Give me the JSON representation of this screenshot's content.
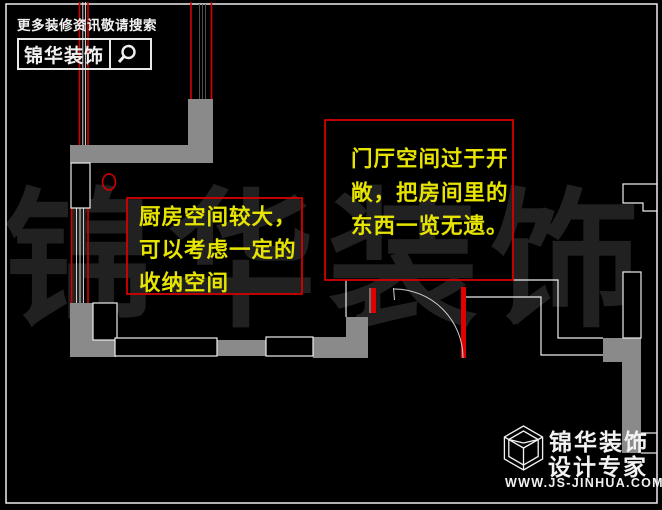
{
  "branding": {
    "tagline": "更多装修资讯敬请搜索",
    "logo_text": "锦华装饰",
    "search_icon": "magnifier-icon"
  },
  "annotations": {
    "kitchen": {
      "lines": [
        "厨房空间较大，",
        "可以考虑一定的",
        "收纳空间"
      ],
      "border_color": "#d40000",
      "text_color": "#e6e400"
    },
    "hallway": {
      "lines": [
        "门厅空间过于开",
        "敞，把房间里的",
        "东西一览无遗。"
      ],
      "border_color": "#d40000",
      "text_color": "#e6e400"
    }
  },
  "watermark": {
    "text": "锦华装饰",
    "color": "#212121"
  },
  "footer_logo": {
    "company": "锦华装饰",
    "slogan": "设计专家",
    "website": "WWW.JS-JINHUA.COM",
    "cube_icon": "cube-logo-icon"
  },
  "plan": {
    "wall_fill_color": "#8a8a8a",
    "line_color": "#ededed",
    "accent_red": "#d40000",
    "door_jamb_red": "#e00000",
    "background": "#000000"
  }
}
